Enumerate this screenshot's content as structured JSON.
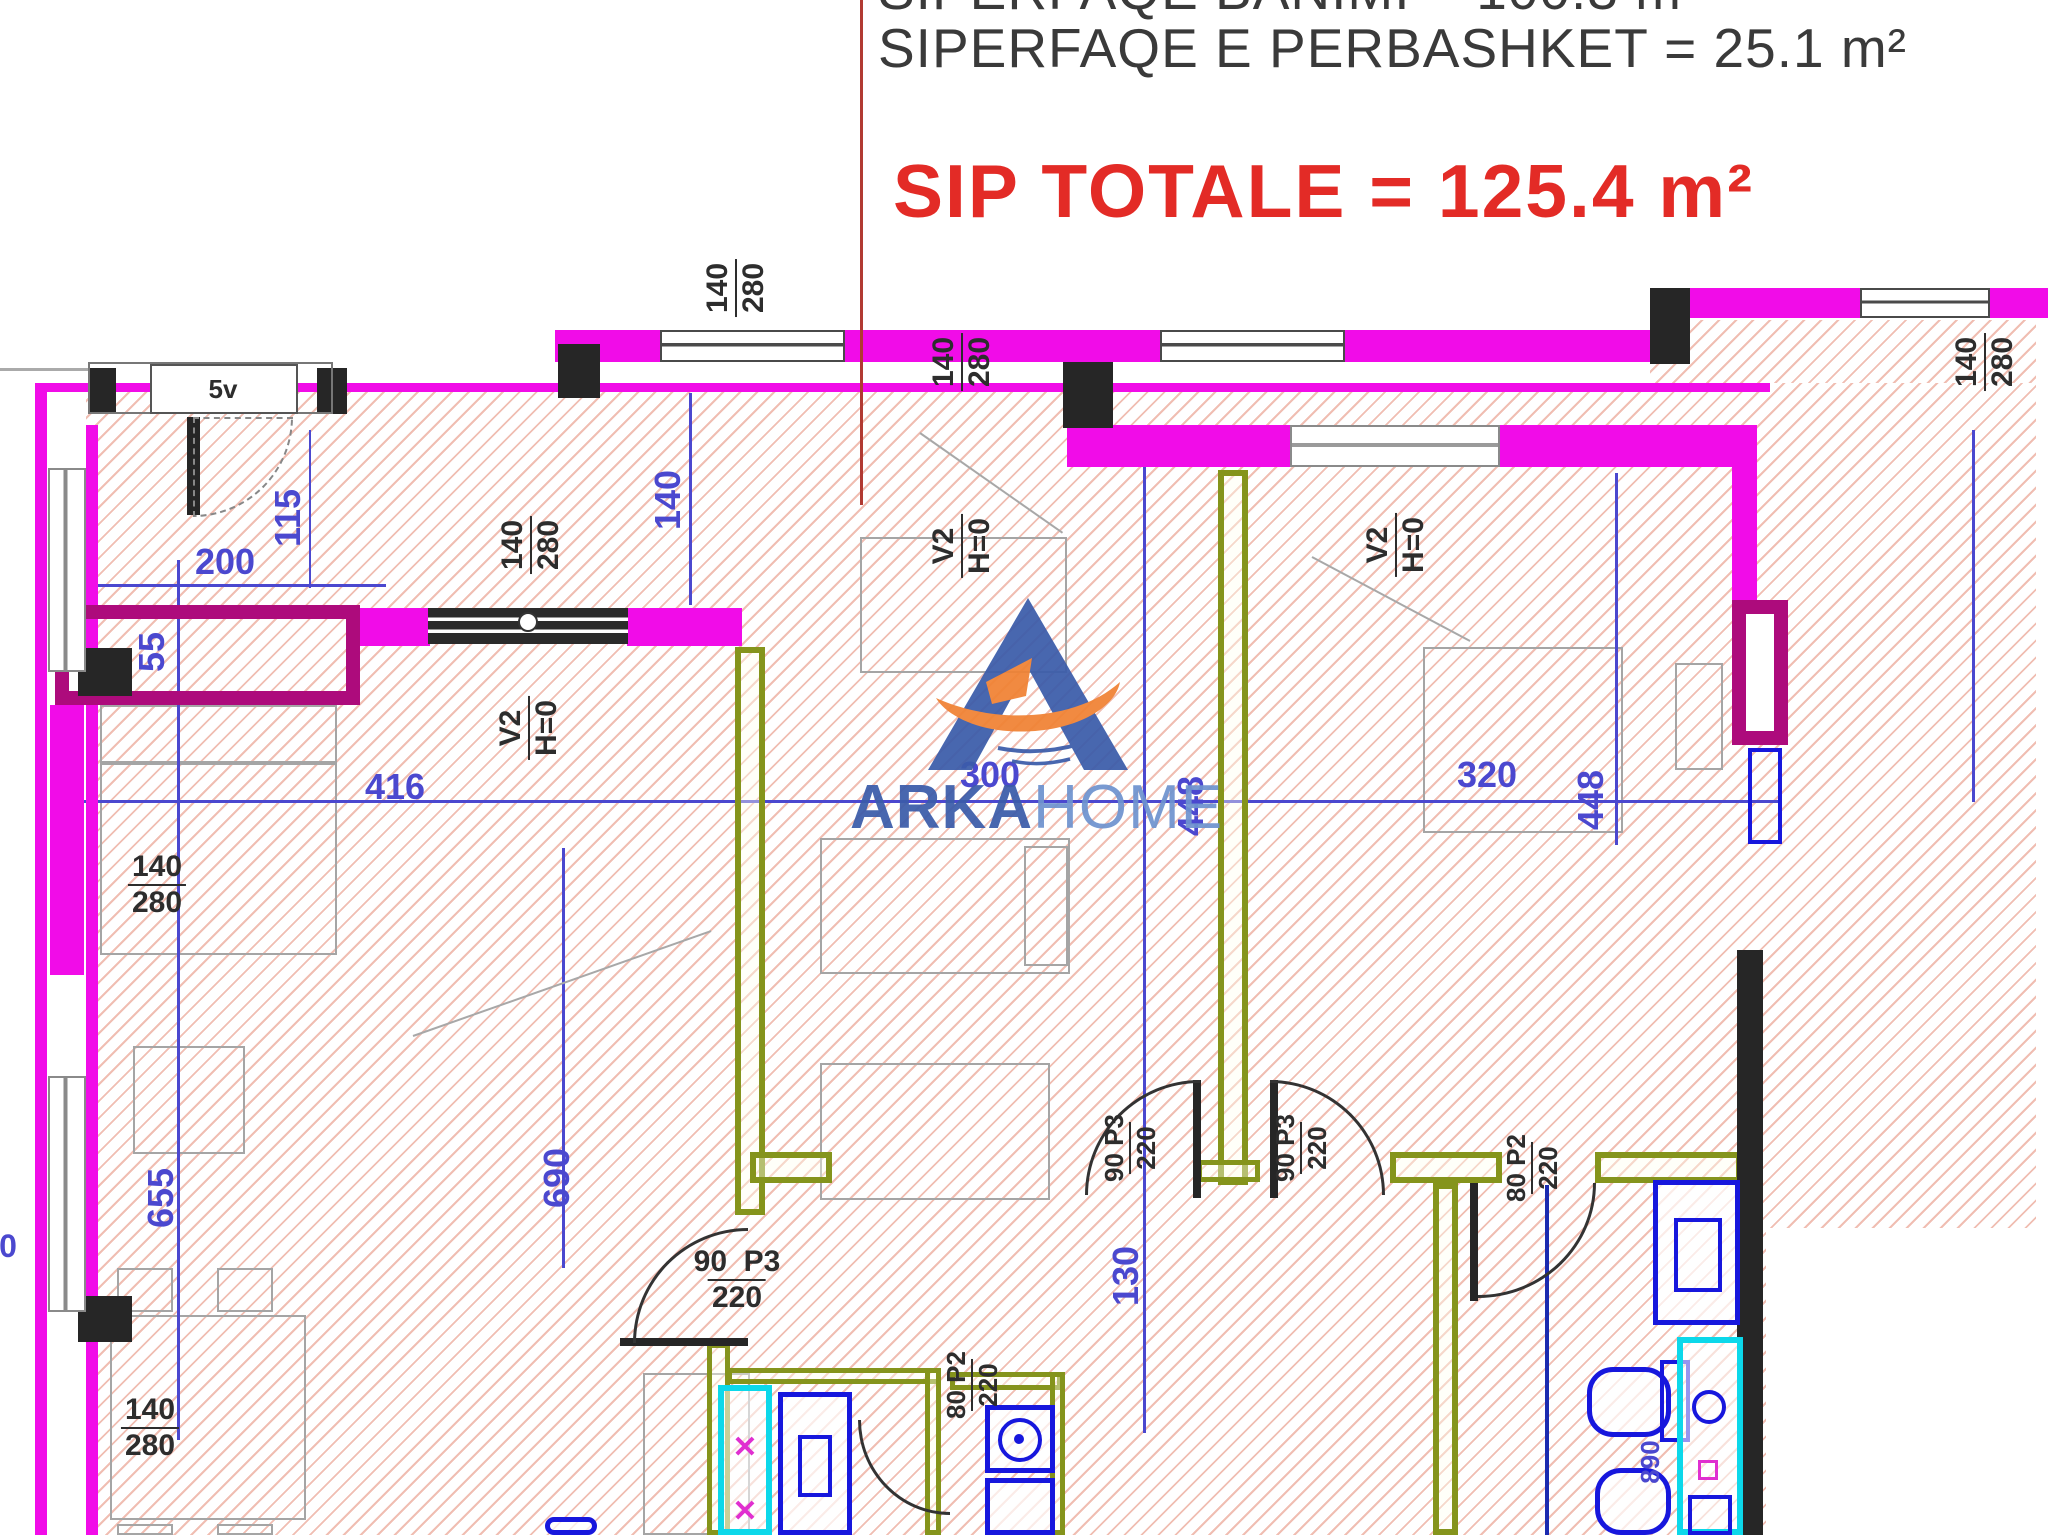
{
  "header": {
    "line1": "SIPERFAQE BANIMI = 100.3 m²",
    "line2": "SIPERFAQE E PERBASHKET = 25.1 m²",
    "total": "SIP TOTALE = 125.4 m²"
  },
  "logo": {
    "brand_bold": "ARKA",
    "brand_light": "HOME"
  },
  "colors": {
    "title_red": "#e32b26",
    "divider_red": "#b13a32",
    "wall_magenta": "#f10ce8",
    "wall_dark_magenta": "#ad0b7c",
    "wall_olive": "#85941c",
    "dim_blue": "#4b48cf",
    "fixture_blue": "#1717dd",
    "fixture_cyan": "#0cd8ea",
    "logo_blue": "#3b5caa",
    "logo_orange": "#f08233"
  },
  "plan": {
    "rects": [
      [
        35,
        383,
        2001,
        1152,
        "hatch",
        "hatch-region"
      ],
      [
        1650,
        320,
        386,
        63,
        "hatch",
        "hatch-region"
      ],
      [
        47,
        392,
        39,
        1143,
        "mask",
        "wall-channel"
      ],
      [
        1766,
        1228,
        282,
        307,
        "mask",
        "outside-area"
      ],
      [
        100,
        705,
        237,
        58,
        "furn",
        "sofa"
      ],
      [
        100,
        763,
        237,
        192,
        "furn",
        "sofa"
      ],
      [
        133,
        1046,
        112,
        108,
        "furn",
        "armchair"
      ],
      [
        110,
        1315,
        196,
        205,
        "furn",
        "dining-table"
      ],
      [
        117,
        1268,
        56,
        44,
        "furn",
        "chair"
      ],
      [
        217,
        1268,
        56,
        44,
        "furn",
        "chair"
      ],
      [
        117,
        1524,
        56,
        11,
        "furn",
        "chair"
      ],
      [
        217,
        1524,
        56,
        11,
        "furn",
        "chair"
      ],
      [
        820,
        838,
        250,
        136,
        "furn",
        "bed"
      ],
      [
        1024,
        846,
        44,
        120,
        "furn",
        "pillow"
      ],
      [
        820,
        1063,
        230,
        137,
        "furn",
        "desk"
      ],
      [
        860,
        537,
        207,
        136,
        "furn",
        "wardrobe"
      ],
      [
        1423,
        647,
        200,
        186,
        "furn",
        "bed"
      ],
      [
        1675,
        663,
        48,
        107,
        "furn",
        "nightstand"
      ],
      [
        643,
        1373,
        107,
        162,
        "furn",
        "counter"
      ],
      [
        70,
        800,
        1712,
        3,
        "line-b",
        "dimension-line"
      ],
      [
        177,
        560,
        3,
        880,
        "line-b",
        "dimension-line"
      ],
      [
        562,
        848,
        3,
        420,
        "line-b",
        "dimension-line"
      ],
      [
        689,
        393,
        3,
        212,
        "line-b",
        "dimension-line"
      ],
      [
        1143,
        458,
        3,
        975,
        "line-b",
        "dimension-line"
      ],
      [
        1615,
        473,
        3,
        372,
        "line-b",
        "dimension-line"
      ],
      [
        70,
        584,
        316,
        3,
        "line-b",
        "dimension-line"
      ],
      [
        309,
        430,
        2,
        158,
        "line-b",
        "dimension-line"
      ],
      [
        1972,
        430,
        3,
        372,
        "line-b",
        "dimension-line"
      ],
      [
        1545,
        1185,
        4,
        350,
        "line-n",
        "dimension-line"
      ],
      [
        555,
        352,
        1095,
        3,
        "line-g",
        "balcony-edge"
      ],
      [
        0,
        368,
        90,
        3,
        "line-g",
        "balcony-edge"
      ],
      [
        35,
        383,
        1735,
        9,
        "w-m",
        "wall"
      ],
      [
        555,
        330,
        105,
        32,
        "w-m",
        "wall"
      ],
      [
        845,
        330,
        315,
        32,
        "w-m",
        "wall"
      ],
      [
        1345,
        330,
        305,
        32,
        "w-m",
        "wall"
      ],
      [
        1650,
        288,
        210,
        30,
        "w-m",
        "wall"
      ],
      [
        1990,
        288,
        58,
        30,
        "w-m",
        "wall"
      ],
      [
        1067,
        425,
        223,
        42,
        "w-m",
        "wall"
      ],
      [
        1500,
        425,
        257,
        42,
        "w-m",
        "wall"
      ],
      [
        1732,
        425,
        25,
        178,
        "w-m",
        "wall"
      ],
      [
        35,
        383,
        12,
        1152,
        "w-m",
        "wall"
      ],
      [
        86,
        425,
        12,
        1110,
        "w-m",
        "wall"
      ],
      [
        50,
        705,
        34,
        270,
        "w-m",
        "wall"
      ],
      [
        355,
        608,
        75,
        38,
        "w-m",
        "wall"
      ],
      [
        627,
        608,
        115,
        38,
        "w-m",
        "wall"
      ],
      [
        55,
        605,
        305,
        100,
        "w-d-box",
        "closet-wall"
      ],
      [
        1732,
        600,
        56,
        145,
        "w-d-box w-d-fill",
        "shaft-wall"
      ],
      [
        735,
        647,
        30,
        568,
        "w-o",
        "partition-wall"
      ],
      [
        1218,
        470,
        30,
        715,
        "w-o",
        "partition-wall"
      ],
      [
        750,
        1152,
        82,
        31,
        "w-o",
        "partition-wall"
      ],
      [
        1390,
        1152,
        112,
        31,
        "w-o",
        "partition-wall"
      ],
      [
        1595,
        1152,
        147,
        31,
        "w-o",
        "partition-wall"
      ],
      [
        1433,
        1183,
        25,
        352,
        "w-o",
        "partition-wall"
      ],
      [
        727,
        1368,
        214,
        16,
        "w-o t",
        "partition-wall"
      ],
      [
        707,
        1343,
        23,
        192,
        "w-o t",
        "partition-wall"
      ],
      [
        925,
        1368,
        16,
        167,
        "w-o t",
        "partition-wall"
      ],
      [
        950,
        1372,
        112,
        18,
        "w-o t",
        "partition-wall"
      ],
      [
        1050,
        1372,
        15,
        163,
        "w-o t",
        "partition-wall"
      ],
      [
        1197,
        1160,
        63,
        22,
        "w-o t",
        "partition-wall"
      ],
      [
        1737,
        950,
        26,
        585,
        "w-k",
        "wall"
      ],
      [
        558,
        344,
        42,
        54,
        "w-k",
        "column"
      ],
      [
        1063,
        362,
        50,
        66,
        "w-k",
        "column"
      ],
      [
        1650,
        288,
        40,
        76,
        "w-k",
        "column"
      ],
      [
        88,
        368,
        28,
        46,
        "w-k",
        "column"
      ],
      [
        317,
        368,
        30,
        46,
        "w-k",
        "column"
      ],
      [
        78,
        648,
        54,
        48,
        "w-k",
        "column"
      ],
      [
        78,
        1296,
        54,
        46,
        "w-k",
        "column"
      ],
      [
        620,
        1338,
        128,
        8,
        "w-k",
        "door-leaf"
      ],
      [
        187,
        417,
        13,
        98,
        "w-k",
        "door-leaf"
      ],
      [
        1193,
        1080,
        8,
        118,
        "w-k",
        "door-leaf"
      ],
      [
        1270,
        1080,
        8,
        118,
        "w-k",
        "door-leaf"
      ],
      [
        1470,
        1183,
        8,
        118,
        "w-k",
        "door-leaf"
      ],
      [
        660,
        330,
        185,
        32,
        "win-h",
        "window"
      ],
      [
        1160,
        330,
        185,
        32,
        "win-h",
        "window"
      ],
      [
        1860,
        288,
        130,
        30,
        "win-h",
        "window"
      ],
      [
        1290,
        425,
        210,
        42,
        "win-h2",
        "window"
      ],
      [
        48,
        468,
        38,
        204,
        "win-v",
        "window"
      ],
      [
        48,
        1076,
        38,
        236,
        "win-v",
        "window"
      ],
      [
        428,
        608,
        200,
        36,
        "win-dark",
        "window"
      ],
      [
        518,
        612,
        20,
        20,
        "fx-kc",
        "window-pivot"
      ],
      [
        88,
        362,
        245,
        52,
        "box-g",
        "entry-niche"
      ],
      [
        150,
        364,
        148,
        50,
        "box-w",
        "door-tag-box"
      ],
      [
        193,
        417,
        100,
        100,
        "arc br dash",
        "door-arc"
      ],
      [
        633,
        1228,
        115,
        115,
        "arc tl",
        "door-arc"
      ],
      [
        1085,
        1080,
        115,
        115,
        "arc tl",
        "door-arc"
      ],
      [
        1270,
        1080,
        115,
        115,
        "arc tr",
        "door-arc"
      ],
      [
        858,
        1420,
        92,
        95,
        "arc bl",
        "door-arc"
      ],
      [
        1478,
        1183,
        118,
        115,
        "arc br",
        "door-arc"
      ],
      [
        718,
        1385,
        54,
        150,
        "fx-c",
        "shower-tray"
      ],
      [
        778,
        1392,
        74,
        143,
        "fx-b",
        "washing-machine"
      ],
      [
        798,
        1435,
        34,
        62,
        "fx-bi",
        "washing-machine-door"
      ],
      [
        985,
        1405,
        70,
        68,
        "fx-b",
        "stove"
      ],
      [
        998,
        1418,
        44,
        44,
        "fx-cir",
        "stove-burner"
      ],
      [
        1014,
        1434,
        10,
        10,
        "fx-dot",
        "stove-knob"
      ],
      [
        985,
        1478,
        70,
        57,
        "fx-b",
        "oven"
      ],
      [
        1653,
        1180,
        87,
        145,
        "fx-b",
        "washing-machine"
      ],
      [
        1674,
        1218,
        48,
        74,
        "fx-bi",
        "washing-machine-door"
      ],
      [
        1587,
        1367,
        84,
        70,
        "fx-br",
        "toilet"
      ],
      [
        1660,
        1360,
        30,
        82,
        "fx-bi",
        "toilet-tank"
      ],
      [
        1595,
        1468,
        76,
        67,
        "fx-br",
        "bidet"
      ],
      [
        1677,
        1337,
        66,
        198,
        "fx-c",
        "shower-tray"
      ],
      [
        1692,
        1390,
        34,
        34,
        "fx-cir",
        "drain"
      ],
      [
        1698,
        1460,
        20,
        20,
        "fx-m",
        "drain-mark"
      ],
      [
        1688,
        1495,
        44,
        40,
        "fx-bi",
        "sink"
      ],
      [
        1748,
        748,
        34,
        96,
        "fx-bi",
        "boiler"
      ],
      [
        545,
        1517,
        52,
        18,
        "fx-br",
        "sink"
      ]
    ],
    "diagonals": [
      [
        413,
        1035,
        316,
        -19.4
      ],
      [
        920,
        432,
        174,
        35
      ],
      [
        1312,
        556,
        179,
        28
      ]
    ],
    "labels": [
      {
        "t": "200",
        "x": 225,
        "y": 562
      },
      {
        "t": "115",
        "x": 288,
        "y": 518,
        "r": 1
      },
      {
        "t": "55",
        "x": 152,
        "y": 652,
        "r": 1
      },
      {
        "t": "416",
        "x": 395,
        "y": 787
      },
      {
        "t": "140",
        "x": 668,
        "y": 500,
        "r": 1
      },
      {
        "t": "300",
        "x": 990,
        "y": 775
      },
      {
        "t": "448",
        "x": 1191,
        "y": 806,
        "r": 1
      },
      {
        "t": "320",
        "x": 1487,
        "y": 775
      },
      {
        "t": "448",
        "x": 1591,
        "y": 800,
        "r": 1
      },
      {
        "t": "690",
        "x": 557,
        "y": 1178,
        "r": 1
      },
      {
        "t": "655",
        "x": 161,
        "y": 1198,
        "r": 1
      },
      {
        "t": "130",
        "x": 1126,
        "y": 1276,
        "r": 1
      },
      {
        "t": "890",
        "x": 1650,
        "y": 1462,
        "r": 1,
        "s": 26
      },
      {
        "t": "0",
        "x": 8,
        "y": 1246,
        "s": 32
      },
      {
        "a": "140",
        "b": "280",
        "x": 736,
        "y": 288,
        "c": "k",
        "r": 1
      },
      {
        "a": "140",
        "b": "280",
        "x": 962,
        "y": 362,
        "c": "k",
        "r": 1
      },
      {
        "a": "140",
        "b": "280",
        "x": 1985,
        "y": 362,
        "c": "k",
        "r": 1
      },
      {
        "a": "140",
        "b": "280",
        "x": 531,
        "y": 545,
        "c": "k",
        "r": 1
      },
      {
        "a": "V2",
        "b": "H=0",
        "x": 529,
        "y": 728,
        "c": "k",
        "r": 1,
        "n": "window-tag"
      },
      {
        "a": "V2",
        "b": "H=0",
        "x": 962,
        "y": 546,
        "c": "k",
        "r": 1,
        "n": "window-tag"
      },
      {
        "a": "V2",
        "b": "H=0",
        "x": 1396,
        "y": 545,
        "c": "k",
        "r": 1,
        "n": "window-tag"
      },
      {
        "a": "140",
        "b": "280",
        "x": 157,
        "y": 885,
        "c": "k"
      },
      {
        "a": "140",
        "b": "280",
        "x": 150,
        "y": 1428,
        "c": "k"
      },
      {
        "a": "90  P3",
        "b": "220",
        "x": 737,
        "y": 1280,
        "c": "k",
        "n": "door-tag"
      },
      {
        "a": "90 P3",
        "b": "220",
        "x": 1130,
        "y": 1148,
        "c": "k",
        "r": 1,
        "s": 26,
        "n": "door-tag"
      },
      {
        "a": "90 P3",
        "b": "220",
        "x": 1301,
        "y": 1148,
        "c": "k",
        "r": 1,
        "s": 26,
        "n": "door-tag"
      },
      {
        "a": "80 P2",
        "b": "220",
        "x": 972,
        "y": 1385,
        "c": "k",
        "r": 1,
        "s": 26,
        "n": "door-tag"
      },
      {
        "a": "80 P2",
        "b": "220",
        "x": 1532,
        "y": 1168,
        "c": "k",
        "r": 1,
        "s": 26,
        "n": "door-tag"
      },
      {
        "t": "5v",
        "x": 223,
        "y": 389,
        "c": "k",
        "s": 26,
        "n": "door-tag"
      },
      {
        "t": "✕",
        "x": 745,
        "y": 1448,
        "c": "m",
        "s": 30,
        "n": "drain-mark"
      },
      {
        "t": "✕",
        "x": 745,
        "y": 1512,
        "c": "m",
        "s": 30,
        "n": "drain-mark"
      }
    ]
  }
}
